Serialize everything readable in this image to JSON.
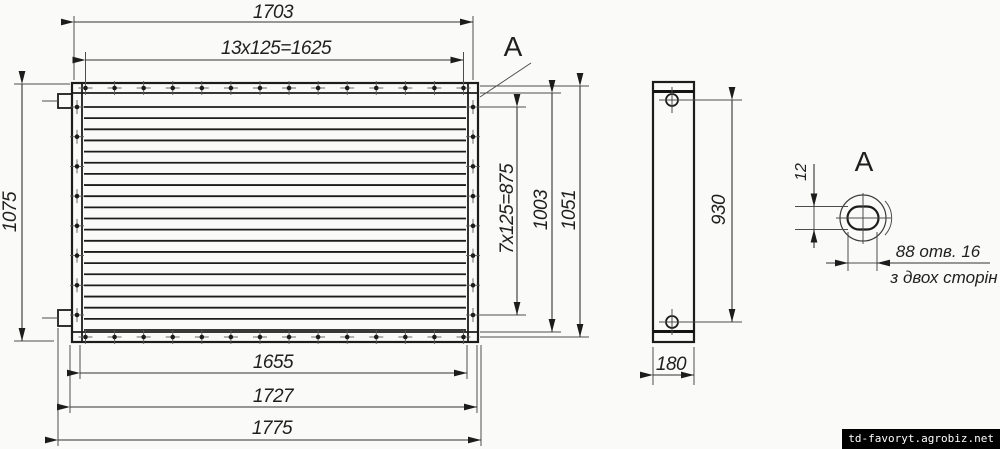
{
  "colors": {
    "background": "#fafaf8",
    "line": "#1c1c1c",
    "dimension": "#333333",
    "watermark_bg": "#000000",
    "watermark_fg": "#ffffff"
  },
  "front_view": {
    "dim_top_overall": "1703",
    "dim_top_bolt_pitch": "13x125=1625",
    "dim_left_height": "1075",
    "dim_right_bolt_pitch": "7x125=875",
    "dim_right_opening": "1003",
    "dim_right_frame": "1051",
    "dim_bottom_opening": "1655",
    "dim_bottom_frame": "1727",
    "dim_bottom_overall": "1775",
    "section_label": "A",
    "bolt_counts": {
      "top": 14,
      "bottom": 14,
      "left": 8,
      "right": 8
    },
    "fin_count": 21
  },
  "side_view": {
    "dim_hole_pitch": "930",
    "dim_depth": "180"
  },
  "detail_view": {
    "label": "A",
    "dim_slot_height": "12",
    "note_line1": "88 отв. 16",
    "note_line2": "з двох сторін"
  },
  "watermark": "td-favoryt.agrobiz.net"
}
